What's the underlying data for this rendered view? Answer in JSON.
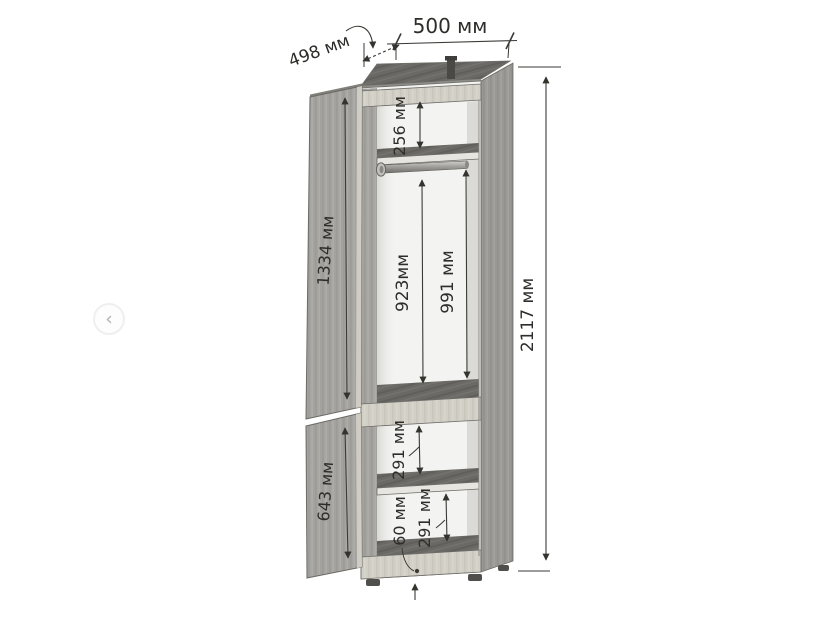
{
  "carousel": {
    "prev_icon": "‹"
  },
  "diagram": {
    "unit": "мм",
    "labels": {
      "width": "500 мм",
      "depth": "498 мм",
      "height": "2117 мм",
      "top_shelf_space": "256 мм",
      "upper_door": "1334 мм",
      "rod_clearance": "923мм",
      "hanging_space": "991 мм",
      "mid_shelf_space": "291 мм",
      "lower_door": "643 мм",
      "bottom_shelf_space": "291 мм",
      "plinth_height": "60 мм"
    },
    "colors": {
      "wood": "#a5a4a0",
      "wood_dark": "#6a6965",
      "wood_light": "#d2cfc6",
      "interior": "#f3f3f1",
      "dimension_line": "#3a3a36",
      "dimension_text": "#2d2d2b",
      "background": "#ffffff"
    }
  }
}
